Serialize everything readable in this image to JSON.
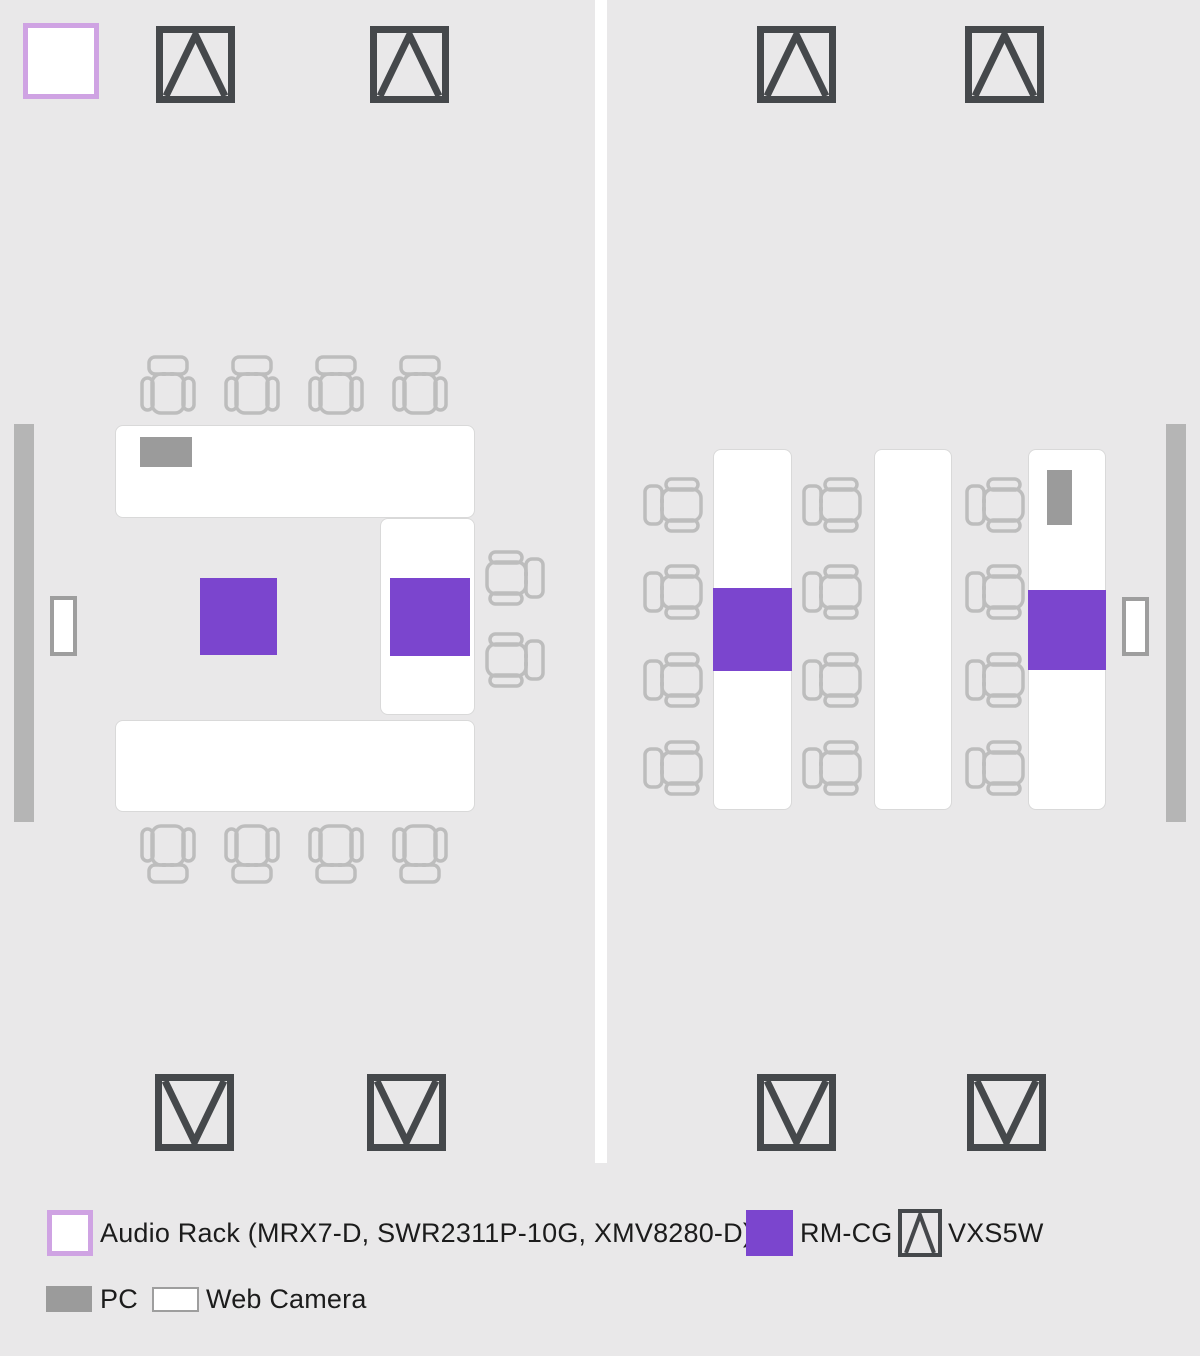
{
  "colors": {
    "background": "#e9e8e9",
    "divider": "#ffffff",
    "table_fill": "#ffffff",
    "table_border": "#d9d9d9",
    "chair_stroke": "#bdbdbd",
    "speaker_stroke": "#45484b",
    "rm_cg_fill": "#7b45ce",
    "audio_rack_border": "#cfa3e3",
    "audio_rack_fill": "#ffffff",
    "pc_fill": "#9b9b9b",
    "webcam_fill": "#ffffff",
    "webcam_border": "#9e9e9e",
    "wall_display_fill": "#b5b5b5",
    "legend_text": "#1c1c1c"
  },
  "legend": {
    "audio_rack_label": "Audio Rack (MRX7-D, SWR2311P-10G, XMV8280-D)",
    "rm_cg_label": "RM-CG",
    "vxs5w_label": "VXS5W",
    "pc_label": "PC",
    "web_camera_label": "Web Camera"
  },
  "floorplan": {
    "canvas": {
      "width": 1200,
      "height": 1356
    },
    "items": [
      {
        "name": "room-divider-wall",
        "type": "rect",
        "x": 595,
        "y": 0,
        "w": 12,
        "h": 1163,
        "fill": "divider"
      },
      {
        "name": "audio-rack",
        "type": "rect",
        "x": 23,
        "y": 23,
        "w": 76,
        "h": 76,
        "fill": "audio_rack_fill",
        "border": {
          "w": 5,
          "color": "audio_rack_border"
        }
      },
      {
        "name": "vxs5w-speaker",
        "type": "speaker",
        "dir": "up",
        "x": 156,
        "y": 26
      },
      {
        "name": "vxs5w-speaker",
        "type": "speaker",
        "dir": "up",
        "x": 370,
        "y": 26
      },
      {
        "name": "vxs5w-speaker",
        "type": "speaker",
        "dir": "up",
        "x": 757,
        "y": 26
      },
      {
        "name": "vxs5w-speaker",
        "type": "speaker",
        "dir": "up",
        "x": 965,
        "y": 26
      },
      {
        "name": "vxs5w-speaker",
        "type": "speaker",
        "dir": "down",
        "x": 155,
        "y": 1074
      },
      {
        "name": "vxs5w-speaker",
        "type": "speaker",
        "dir": "down",
        "x": 367,
        "y": 1074
      },
      {
        "name": "vxs5w-speaker",
        "type": "speaker",
        "dir": "down",
        "x": 757,
        "y": 1074
      },
      {
        "name": "vxs5w-speaker",
        "type": "speaker",
        "dir": "down",
        "x": 967,
        "y": 1074
      },
      {
        "name": "wall-display-left",
        "type": "rect",
        "x": 14,
        "y": 424,
        "w": 20,
        "h": 398,
        "fill": "wall_display_fill"
      },
      {
        "name": "wall-display-right",
        "type": "rect",
        "x": 1166,
        "y": 424,
        "w": 20,
        "h": 398,
        "fill": "wall_display_fill"
      },
      {
        "name": "web-camera-left",
        "type": "rect",
        "x": 50,
        "y": 596,
        "w": 27,
        "h": 60,
        "fill": "webcam_fill",
        "border": {
          "w": 4,
          "color": "webcam_border"
        }
      },
      {
        "name": "web-camera-right",
        "type": "rect",
        "x": 1122,
        "y": 597,
        "w": 27,
        "h": 59,
        "fill": "webcam_fill",
        "border": {
          "w": 4,
          "color": "webcam_border"
        }
      },
      {
        "name": "table",
        "type": "rect",
        "x": 115,
        "y": 425,
        "w": 360,
        "h": 93,
        "fill": "table_fill",
        "border": {
          "w": 1.5,
          "color": "table_border"
        },
        "radius": 8
      },
      {
        "name": "table",
        "type": "rect",
        "x": 380,
        "y": 518,
        "w": 95,
        "h": 197,
        "fill": "table_fill",
        "border": {
          "w": 1.5,
          "color": "table_border"
        },
        "radius": 8
      },
      {
        "name": "table",
        "type": "rect",
        "x": 115,
        "y": 720,
        "w": 360,
        "h": 92,
        "fill": "table_fill",
        "border": {
          "w": 1.5,
          "color": "table_border"
        },
        "radius": 8
      },
      {
        "name": "table",
        "type": "rect",
        "x": 713,
        "y": 449,
        "w": 79,
        "h": 361,
        "fill": "table_fill",
        "border": {
          "w": 1.5,
          "color": "table_border"
        },
        "radius": 8
      },
      {
        "name": "table",
        "type": "rect",
        "x": 874,
        "y": 449,
        "w": 78,
        "h": 361,
        "fill": "table_fill",
        "border": {
          "w": 1.5,
          "color": "table_border"
        },
        "radius": 8
      },
      {
        "name": "table",
        "type": "rect",
        "x": 1028,
        "y": 449,
        "w": 78,
        "h": 361,
        "fill": "table_fill",
        "border": {
          "w": 1.5,
          "color": "table_border"
        },
        "radius": 8
      },
      {
        "name": "pc",
        "type": "rect",
        "x": 140,
        "y": 437,
        "w": 52,
        "h": 30,
        "fill": "pc_fill"
      },
      {
        "name": "pc",
        "type": "rect",
        "x": 1047,
        "y": 470,
        "w": 25,
        "h": 55,
        "fill": "pc_fill"
      },
      {
        "name": "rm-cg-microphone",
        "type": "rect",
        "x": 200,
        "y": 578,
        "w": 77,
        "h": 77,
        "fill": "rm_cg_fill"
      },
      {
        "name": "rm-cg-microphone",
        "type": "rect",
        "x": 390,
        "y": 578,
        "w": 80,
        "h": 78,
        "fill": "rm_cg_fill"
      },
      {
        "name": "rm-cg-microphone",
        "type": "rect",
        "x": 713,
        "y": 588,
        "w": 79,
        "h": 83,
        "fill": "rm_cg_fill"
      },
      {
        "name": "rm-cg-microphone",
        "type": "rect",
        "x": 1028,
        "y": 590,
        "w": 78,
        "h": 80,
        "fill": "rm_cg_fill"
      },
      {
        "name": "chair",
        "type": "chair",
        "rot": 0,
        "x": 140,
        "y": 355,
        "w": 56,
        "h": 64
      },
      {
        "name": "chair",
        "type": "chair",
        "rot": 0,
        "x": 224,
        "y": 355,
        "w": 56,
        "h": 64
      },
      {
        "name": "chair",
        "type": "chair",
        "rot": 0,
        "x": 308,
        "y": 355,
        "w": 56,
        "h": 64
      },
      {
        "name": "chair",
        "type": "chair",
        "rot": 0,
        "x": 392,
        "y": 355,
        "w": 56,
        "h": 64
      },
      {
        "name": "chair",
        "type": "chair",
        "rot": 180,
        "x": 140,
        "y": 820,
        "w": 56,
        "h": 64
      },
      {
        "name": "chair",
        "type": "chair",
        "rot": 180,
        "x": 224,
        "y": 820,
        "w": 56,
        "h": 64
      },
      {
        "name": "chair",
        "type": "chair",
        "rot": 180,
        "x": 308,
        "y": 820,
        "w": 56,
        "h": 64
      },
      {
        "name": "chair",
        "type": "chair",
        "rot": 180,
        "x": 392,
        "y": 820,
        "w": 56,
        "h": 64
      },
      {
        "name": "chair",
        "type": "chair",
        "rot": 90,
        "x": 481,
        "y": 550,
        "w": 64,
        "h": 56
      },
      {
        "name": "chair",
        "type": "chair",
        "rot": 90,
        "x": 481,
        "y": 632,
        "w": 64,
        "h": 56
      },
      {
        "name": "chair",
        "type": "chair",
        "rot": 270,
        "x": 643,
        "y": 477,
        "w": 64,
        "h": 56
      },
      {
        "name": "chair",
        "type": "chair",
        "rot": 270,
        "x": 643,
        "y": 564,
        "w": 64,
        "h": 56
      },
      {
        "name": "chair",
        "type": "chair",
        "rot": 270,
        "x": 643,
        "y": 652,
        "w": 64,
        "h": 56
      },
      {
        "name": "chair",
        "type": "chair",
        "rot": 270,
        "x": 643,
        "y": 740,
        "w": 64,
        "h": 56
      },
      {
        "name": "chair",
        "type": "chair",
        "rot": 270,
        "x": 802,
        "y": 477,
        "w": 64,
        "h": 56
      },
      {
        "name": "chair",
        "type": "chair",
        "rot": 270,
        "x": 802,
        "y": 564,
        "w": 64,
        "h": 56
      },
      {
        "name": "chair",
        "type": "chair",
        "rot": 270,
        "x": 802,
        "y": 652,
        "w": 64,
        "h": 56
      },
      {
        "name": "chair",
        "type": "chair",
        "rot": 270,
        "x": 802,
        "y": 740,
        "w": 64,
        "h": 56
      },
      {
        "name": "chair",
        "type": "chair",
        "rot": 270,
        "x": 965,
        "y": 477,
        "w": 64,
        "h": 56
      },
      {
        "name": "chair",
        "type": "chair",
        "rot": 270,
        "x": 965,
        "y": 564,
        "w": 64,
        "h": 56
      },
      {
        "name": "chair",
        "type": "chair",
        "rot": 270,
        "x": 965,
        "y": 652,
        "w": 64,
        "h": 56
      },
      {
        "name": "chair",
        "type": "chair",
        "rot": 270,
        "x": 965,
        "y": 740,
        "w": 64,
        "h": 56
      }
    ]
  }
}
